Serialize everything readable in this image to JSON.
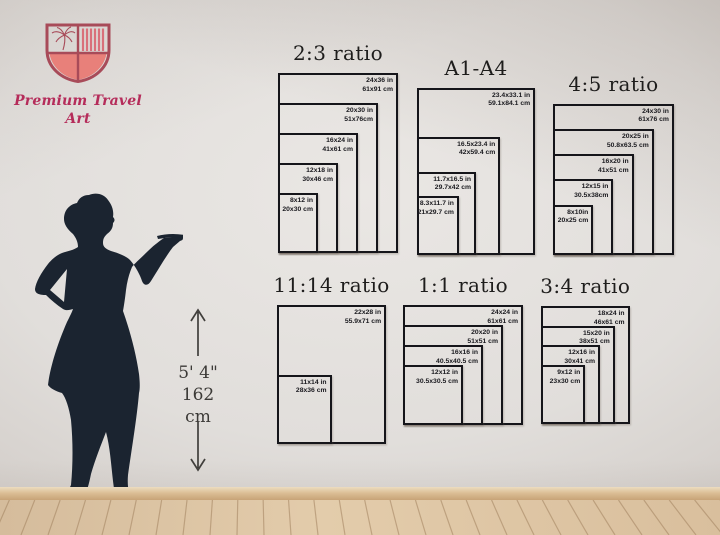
{
  "brand": {
    "name": "Premium Travel Art"
  },
  "height_marker": {
    "imperial": "5' 4\"",
    "metric": "162 cm"
  },
  "charts": [
    {
      "id": "ratio-2-3",
      "title": "2:3 ratio",
      "sizes": [
        {
          "inches": "24x36 in",
          "cm": "61x91 cm",
          "w": 24,
          "h": 36
        },
        {
          "inches": "20x30 in",
          "cm": "51x76cm",
          "w": 20,
          "h": 30
        },
        {
          "inches": "16x24 in",
          "cm": "41x61 cm",
          "w": 16,
          "h": 24
        },
        {
          "inches": "12x18 in",
          "cm": "30x46 cm",
          "w": 12,
          "h": 18
        },
        {
          "inches": "8x12 in",
          "cm": "20x30 cm",
          "w": 8,
          "h": 12
        }
      ]
    },
    {
      "id": "a1-a4",
      "title": "A1-A4",
      "sizes": [
        {
          "inches": "23.4x33.1 in",
          "cm": "59.1x84.1 cm",
          "w": 23.4,
          "h": 33.1
        },
        {
          "inches": "16.5x23.4 in",
          "cm": "42x59.4 cm",
          "w": 16.5,
          "h": 23.4
        },
        {
          "inches": "11.7x16.5 in",
          "cm": "29.7x42 cm",
          "w": 11.7,
          "h": 16.5
        },
        {
          "inches": "8.3x11.7 in",
          "cm": "21x29.7 cm",
          "w": 8.3,
          "h": 11.7
        }
      ]
    },
    {
      "id": "ratio-4-5",
      "title": "4:5 ratio",
      "sizes": [
        {
          "inches": "24x30 in",
          "cm": "61x76 cm",
          "w": 24,
          "h": 30
        },
        {
          "inches": "20x25 in",
          "cm": "50.8x63.5 cm",
          "w": 20,
          "h": 25
        },
        {
          "inches": "16x20 in",
          "cm": "41x51 cm",
          "w": 16,
          "h": 20
        },
        {
          "inches": "12x15 in",
          "cm": "30.5x38cm",
          "w": 12,
          "h": 15
        },
        {
          "inches": "8x10in",
          "cm": "20x25 cm",
          "w": 8,
          "h": 10
        }
      ]
    },
    {
      "id": "ratio-11-14",
      "title": "11:14 ratio",
      "sizes": [
        {
          "inches": "22x28 in",
          "cm": "55.9x71 cm",
          "w": 22,
          "h": 28
        },
        {
          "inches": "11x14 in",
          "cm": "28x36 cm",
          "w": 11,
          "h": 14
        }
      ]
    },
    {
      "id": "ratio-1-1",
      "title": "1:1 ratio",
      "sizes": [
        {
          "inches": "24x24 in",
          "cm": "61x61 cm",
          "w": 24,
          "h": 24
        },
        {
          "inches": "20x20 in",
          "cm": "51x51 cm",
          "w": 20,
          "h": 20
        },
        {
          "inches": "16x16 in",
          "cm": "40.5x40.5 cm",
          "w": 16,
          "h": 16
        },
        {
          "inches": "12x12 in",
          "cm": "30.5x30.5 cm",
          "w": 12,
          "h": 12
        }
      ]
    },
    {
      "id": "ratio-3-4",
      "title": "3:4 ratio",
      "sizes": [
        {
          "inches": "18x24 in",
          "cm": "46x61 cm",
          "w": 18,
          "h": 24
        },
        {
          "inches": "15x20 in",
          "cm": "38x51 cm",
          "w": 15,
          "h": 20
        },
        {
          "inches": "12x16 in",
          "cm": "30x41 cm",
          "w": 12,
          "h": 16
        },
        {
          "inches": "9x12 in",
          "cm": "23x30 cm",
          "w": 9,
          "h": 12
        }
      ]
    }
  ],
  "colors": {
    "accent_coral": "#e8807a",
    "accent_crimson": "#a84b59",
    "brand_pink": "#b52c5a",
    "frame_line": "#15151a",
    "silhouette": "#1b2430"
  }
}
